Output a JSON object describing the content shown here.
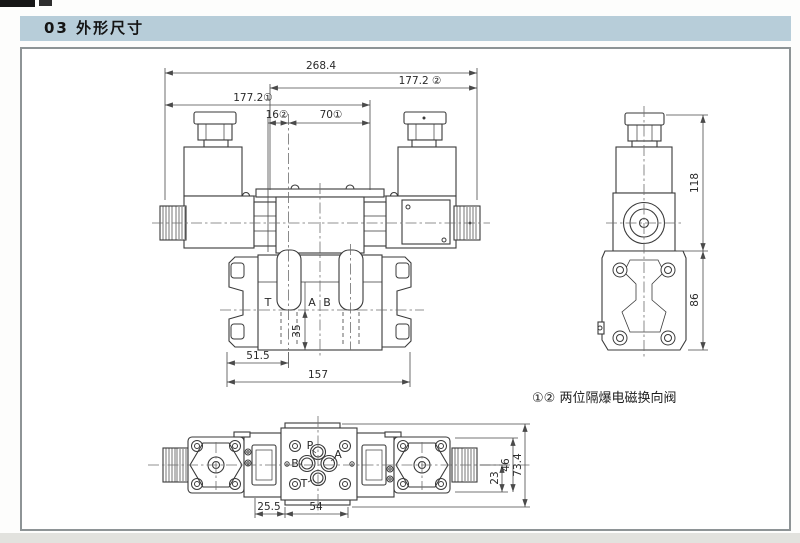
{
  "page": {
    "header": "03 外形尺寸"
  },
  "caption": "①② 两位隔爆电磁换向阀",
  "colors": {
    "header_bg": "#b7cdd9",
    "line": "#3a3a3a",
    "frame_border": "#8e9496"
  },
  "front_view": {
    "dim_overall": "268.4",
    "dim_span_right": "177.2 ②",
    "dim_span_left": "177.2①",
    "dim_16": "16②",
    "dim_70": "70①",
    "dim_35": "35",
    "dim_51_5": "51.5",
    "dim_157": "157",
    "port_t": "T",
    "port_a": "A",
    "port_b": "B"
  },
  "side_view": {
    "dim_118": "118",
    "dim_86": "86"
  },
  "bottom_view": {
    "dim_25_5": "25.5",
    "dim_54": "54",
    "dim_23": "23",
    "dim_46": "46",
    "dim_73_4": "73.4",
    "port_p": "P",
    "port_a": "A",
    "port_b": "B",
    "port_t": "T"
  }
}
